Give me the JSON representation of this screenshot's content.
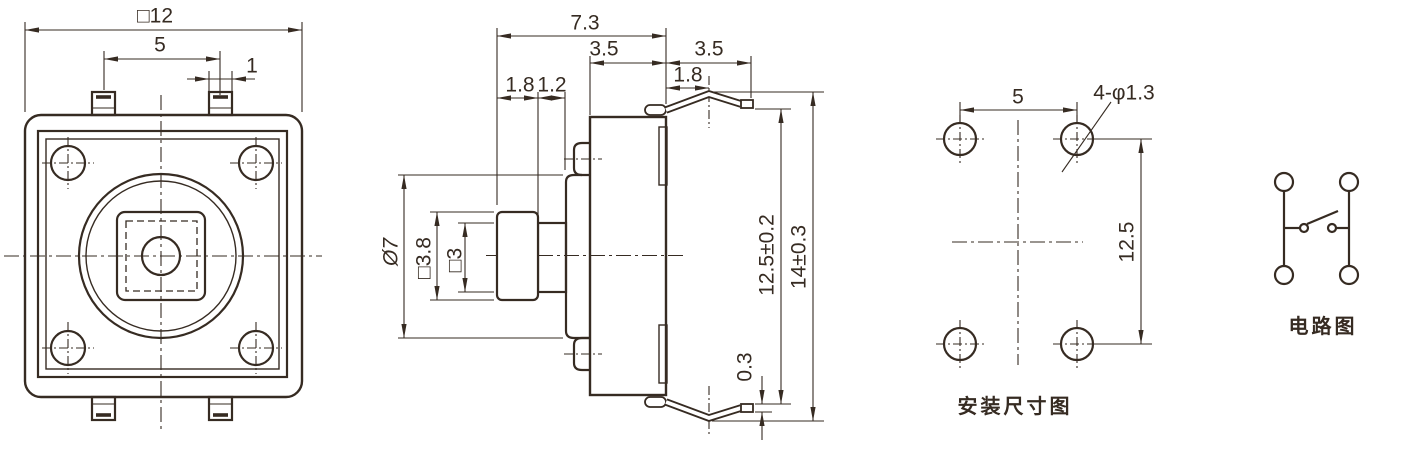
{
  "colors": {
    "line": "#362b22",
    "background": "#ffffff"
  },
  "front_view": {
    "dim_body_width": "□12",
    "dim_pin_spacing": "5",
    "dim_pin_width": "1"
  },
  "side_view": {
    "dim_total_depth": "7.3",
    "dim_body_depth": "3.5",
    "dim_lead_extension": "3.5",
    "dim_lead_bend": "1.8",
    "dim_plunger_tip_depth": "1.8",
    "dim_plunger_neck_depth": "1.2",
    "dim_flange_diameter": "Ø7",
    "dim_plunger_tip_square": "□3.8",
    "dim_plunger_neck_square": "□3",
    "dim_lead_tip_span": "12.5±0.2",
    "dim_overall_height": "14±0.3",
    "dim_lead_thickness": "0.3"
  },
  "mounting_view": {
    "caption": "安装尺寸图",
    "dim_hole_spacing_h": "5",
    "dim_hole_callout": "4-φ1.3",
    "dim_hole_spacing_v": "12.5"
  },
  "circuit_view": {
    "caption": "电路图"
  }
}
